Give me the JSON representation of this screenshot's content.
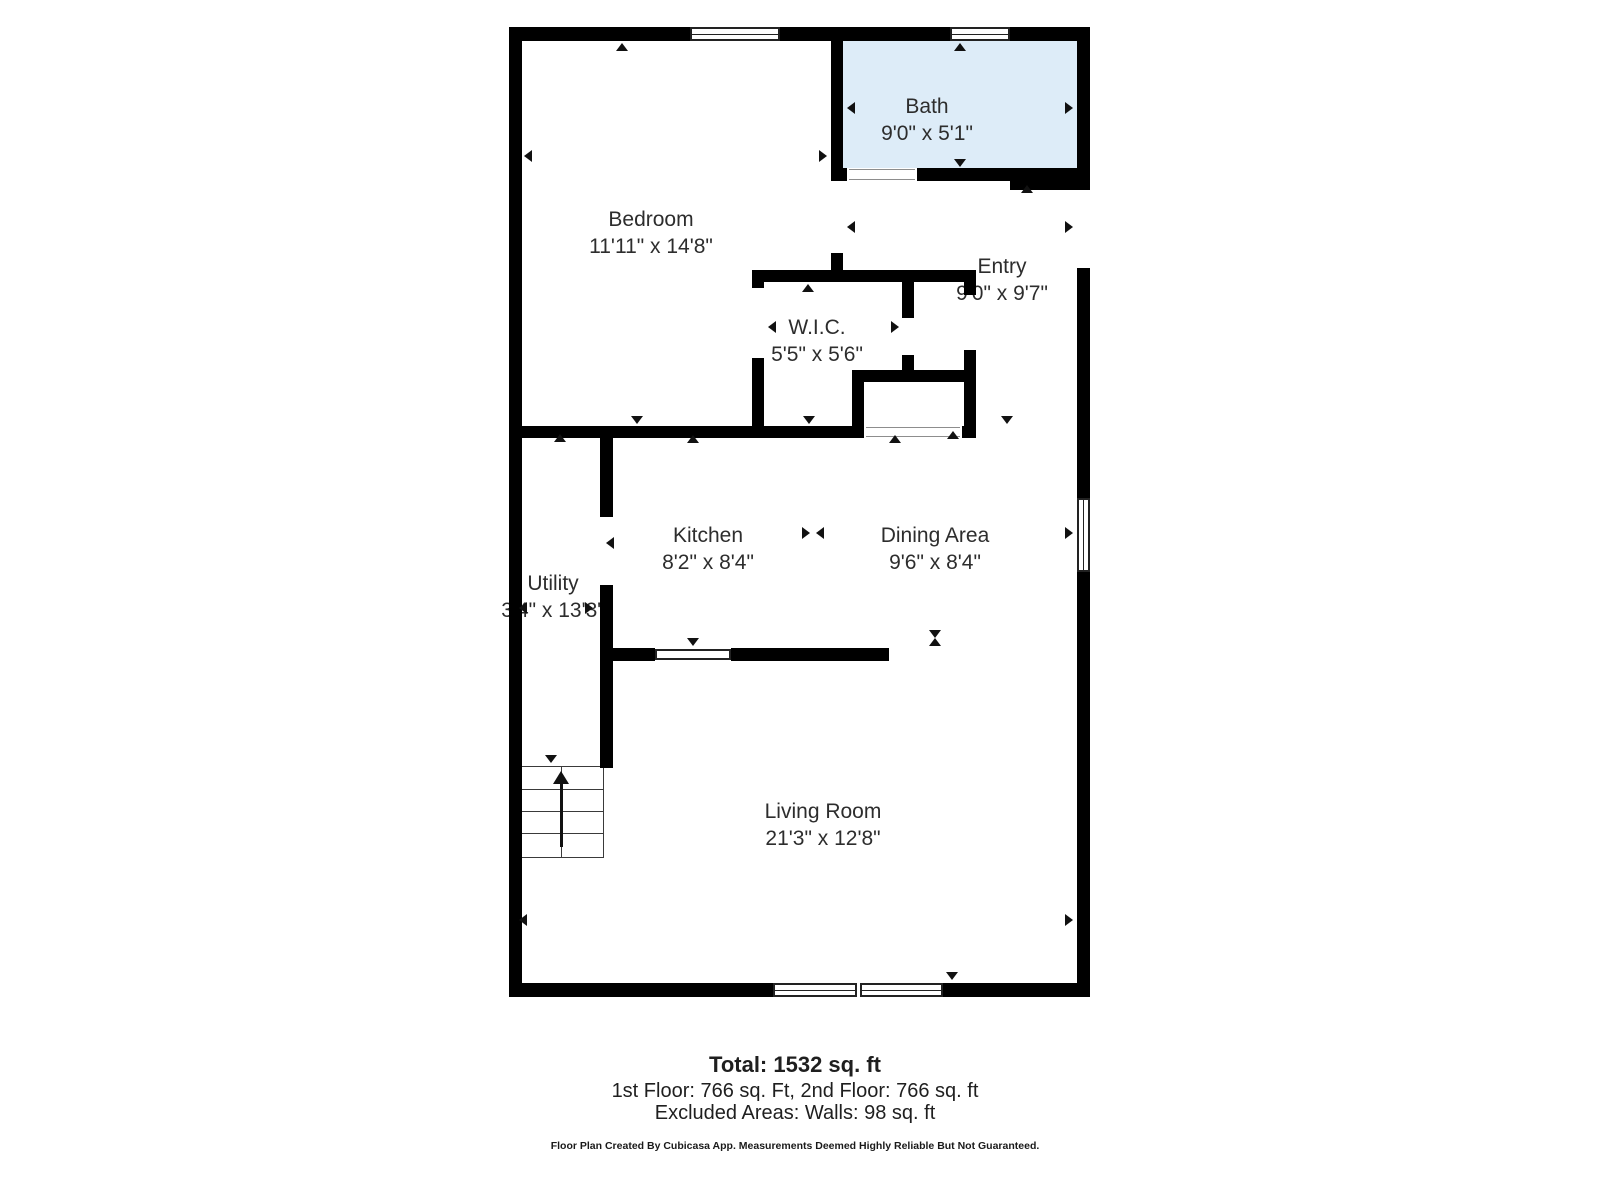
{
  "plan": {
    "colors": {
      "wall": "#000000",
      "label": "#2d2d2d",
      "bath_fill": "#ddecf8",
      "window_frame": "#222222",
      "threshold_line": "#8d8d8d"
    },
    "rooms": [
      {
        "id": "bath",
        "label": "Bath",
        "dims": "9'0\" x 5'1\"",
        "cx": 927,
        "cy": 120,
        "fill": {
          "x": 843,
          "y": 41,
          "w": 234,
          "h": 127,
          "color": "#ddecf8"
        }
      },
      {
        "id": "bedroom",
        "label": "Bedroom",
        "dims": "11'11\" x 14'8\"",
        "cx": 651,
        "cy": 233
      },
      {
        "id": "entry",
        "label": "Entry",
        "dims": "9'0\" x 9'7\"",
        "cx": 1002,
        "cy": 280
      },
      {
        "id": "wic",
        "label": "W.I.C.",
        "dims": "5'5\" x 5'6\"",
        "cx": 817,
        "cy": 341
      },
      {
        "id": "kitchen",
        "label": "Kitchen",
        "dims": "8'2\" x 8'4\"",
        "cx": 708,
        "cy": 549
      },
      {
        "id": "dining-area",
        "label": "Dining Area",
        "dims": "9'6\" x 8'4\"",
        "cx": 935,
        "cy": 549
      },
      {
        "id": "utility",
        "label": "Utility",
        "dims": "3'4\" x 13'3\"",
        "cx": 553,
        "cy": 597
      },
      {
        "id": "living-room",
        "label": "Living Room",
        "dims": "21'3\" x 12'8\"",
        "cx": 823,
        "cy": 825
      }
    ],
    "walls": [
      [
        509,
        27,
        581,
        14
      ],
      [
        509,
        27,
        13,
        970
      ],
      [
        509,
        983,
        581,
        14
      ],
      [
        1077,
        27,
        13,
        163
      ],
      [
        1077,
        268,
        13,
        230
      ],
      [
        1077,
        572,
        13,
        425
      ],
      [
        831,
        41,
        12,
        140
      ],
      [
        831,
        253,
        12,
        29
      ],
      [
        831,
        168,
        16,
        13
      ],
      [
        917,
        168,
        93,
        13
      ],
      [
        1010,
        168,
        67,
        22
      ],
      [
        752,
        270,
        224,
        12
      ],
      [
        752,
        270,
        12,
        18
      ],
      [
        752,
        358,
        12,
        80
      ],
      [
        902,
        282,
        12,
        36
      ],
      [
        902,
        355,
        12,
        17
      ],
      [
        852,
        370,
        124,
        12
      ],
      [
        852,
        382,
        12,
        56
      ],
      [
        964,
        282,
        12,
        13
      ],
      [
        964,
        350,
        12,
        88
      ],
      [
        509,
        426,
        355,
        12
      ],
      [
        962,
        426,
        14,
        12
      ],
      [
        600,
        438,
        13,
        79
      ],
      [
        600,
        585,
        13,
        183
      ],
      [
        613,
        648,
        42,
        13
      ],
      [
        731,
        648,
        158,
        13
      ]
    ],
    "windows": [
      {
        "x": 690,
        "y": 27,
        "w": 90,
        "h": 14,
        "o": "h"
      },
      {
        "x": 950,
        "y": 27,
        "w": 60,
        "h": 14,
        "o": "h"
      },
      {
        "x": 1077,
        "y": 498,
        "w": 13,
        "h": 74,
        "o": "v"
      },
      {
        "x": 773,
        "y": 983,
        "w": 170,
        "h": 14,
        "o": "h",
        "double": true
      },
      {
        "x": 655,
        "y": 649,
        "w": 76,
        "h": 11,
        "o": "plain"
      }
    ],
    "thresholds": [
      {
        "x": 849,
        "y": 169,
        "w": 66,
        "h": 11
      },
      {
        "x": 866,
        "y": 427,
        "w": 94,
        "h": 10
      }
    ],
    "arrows": [
      {
        "x": 622,
        "y": 43,
        "d": "up"
      },
      {
        "x": 524,
        "y": 156,
        "d": "left"
      },
      {
        "x": 827,
        "y": 156,
        "d": "right"
      },
      {
        "x": 637,
        "y": 424,
        "d": "down"
      },
      {
        "x": 960,
        "y": 43,
        "d": "up"
      },
      {
        "x": 847,
        "y": 108,
        "d": "left"
      },
      {
        "x": 1073,
        "y": 108,
        "d": "right"
      },
      {
        "x": 960,
        "y": 167,
        "d": "down"
      },
      {
        "x": 1027,
        "y": 185,
        "d": "up"
      },
      {
        "x": 847,
        "y": 227,
        "d": "left"
      },
      {
        "x": 1073,
        "y": 227,
        "d": "right"
      },
      {
        "x": 1007,
        "y": 424,
        "d": "down"
      },
      {
        "x": 808,
        "y": 284,
        "d": "up"
      },
      {
        "x": 768,
        "y": 327,
        "d": "left"
      },
      {
        "x": 899,
        "y": 327,
        "d": "right"
      },
      {
        "x": 809,
        "y": 424,
        "d": "down"
      },
      {
        "x": 953,
        "y": 431,
        "d": "up"
      },
      {
        "x": 693,
        "y": 435,
        "d": "up"
      },
      {
        "x": 606,
        "y": 543,
        "d": "left"
      },
      {
        "x": 693,
        "y": 646,
        "d": "down"
      },
      {
        "x": 810,
        "y": 533,
        "d": "right"
      },
      {
        "x": 816,
        "y": 533,
        "d": "left"
      },
      {
        "x": 895,
        "y": 435,
        "d": "up"
      },
      {
        "x": 1073,
        "y": 533,
        "d": "right"
      },
      {
        "x": 935,
        "y": 638,
        "d": "down"
      },
      {
        "x": 935,
        "y": 638,
        "d": "up"
      },
      {
        "x": 560,
        "y": 434,
        "d": "up"
      },
      {
        "x": 519,
        "y": 608,
        "d": "left"
      },
      {
        "x": 593,
        "y": 608,
        "d": "right"
      },
      {
        "x": 551,
        "y": 763,
        "d": "down"
      },
      {
        "x": 519,
        "y": 920,
        "d": "left"
      },
      {
        "x": 1073,
        "y": 920,
        "d": "right"
      },
      {
        "x": 952,
        "y": 980,
        "d": "down"
      }
    ],
    "stairs": {
      "x": 516,
      "y": 766,
      "w": 88,
      "h": 92,
      "treads": [
        22,
        44,
        66
      ],
      "center": 44,
      "arrow": {
        "x": 44,
        "tipY": 4,
        "stemTop": 17,
        "stemBottom": 80
      }
    }
  },
  "footer": {
    "total": "Total: 1532 sq. ft",
    "floors": "1st Floor: 766 sq. Ft, 2nd Floor: 766 sq. ft",
    "excluded": "Excluded Areas: Walls: 98 sq. ft",
    "disclaimer": "Floor Plan Created By Cubicasa App. Measurements Deemed Highly Reliable But Not Guaranteed."
  }
}
